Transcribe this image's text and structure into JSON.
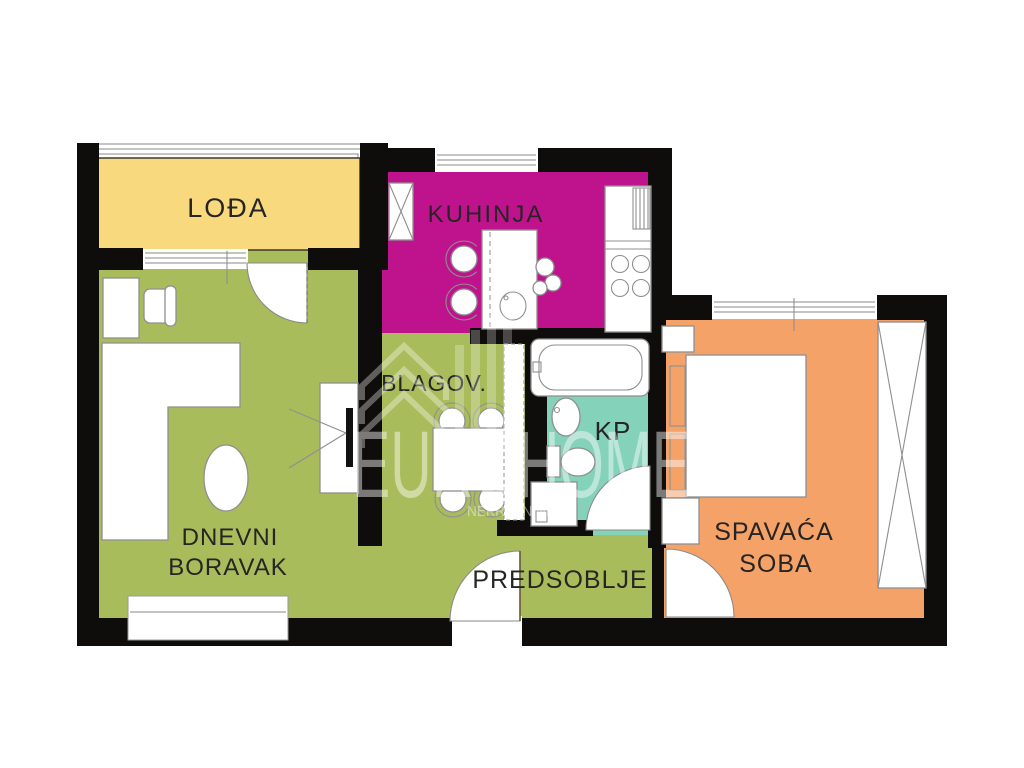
{
  "plan_title": "Apartment floor plan",
  "watermark": {
    "brand": "EUROHOME",
    "subtitle": "NEKRETNINE"
  },
  "colors": {
    "wall": "#0f0d0b",
    "loggia": "#f8d97d",
    "kitchen": "#bf138e",
    "living": "#a8bc5c",
    "bath": "#85d2ba",
    "bedroom": "#f4a268",
    "label": "#262524",
    "watermark": "#ffffff"
  },
  "rooms": {
    "loggia": {
      "label": "LOĐA"
    },
    "kitchen": {
      "label": "KUHINJA"
    },
    "dining": {
      "label": "BLAGOV."
    },
    "bath": {
      "label": "KP"
    },
    "bedroom": {
      "line1": "SPAVAĆA",
      "line2": "SOBA"
    },
    "living": {
      "line1": "DNEVNI",
      "line2": "BORAVAK"
    },
    "hallway": {
      "label": "PREDSOBLJE"
    }
  }
}
